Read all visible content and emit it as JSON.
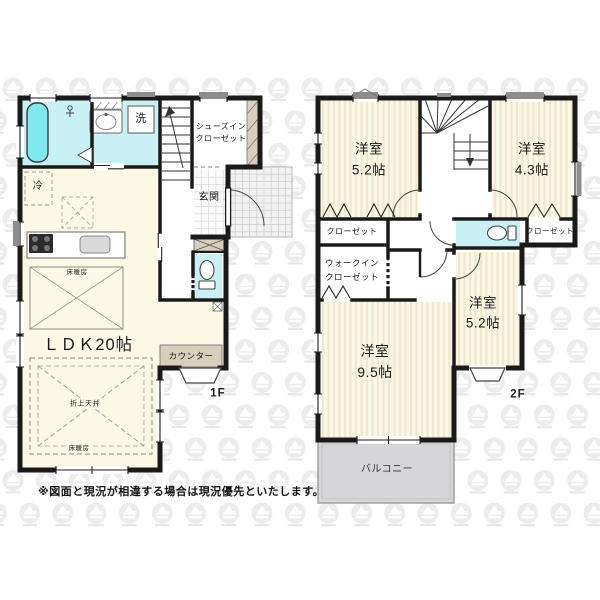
{
  "footnote": "※図面と現況が相違する場合は現況優先といたします。",
  "floor1": {
    "label": "1F",
    "ldk_label": "ＬＤＫ20帖",
    "entrance": "玄関",
    "shoes_closet_line1": "シューズイン",
    "shoes_closet_line2": "クローゼット",
    "laundry": "洗",
    "fridge": "冷",
    "counter": "カウンター",
    "floor_heating_top": "床暖房",
    "raised_ceiling": "折上天井",
    "floor_heating_bottom": "床暖房"
  },
  "floor2": {
    "label": "2F",
    "room_top_left": {
      "name": "洋室",
      "size": "5.2帖"
    },
    "room_top_right": {
      "name": "洋室",
      "size": "4.3帖"
    },
    "room_mid_right": {
      "name": "洋室",
      "size": "5.2帖"
    },
    "room_bottom_left": {
      "name": "洋室",
      "size": "9.5帖"
    },
    "closet_left": "クローゼット",
    "closet_right": "クローゼット",
    "wic_line1": "ウォークイン",
    "wic_line2": "クローゼット",
    "balcony": "バルコニー"
  },
  "colors": {
    "wall": "#1a1a1a",
    "room_cream": "#fcf8e6",
    "stripe": "#f0e7cf",
    "wet_cyan": "#c9f1f5",
    "tub_cyan": "#7fe9ed",
    "closet_beige": "#d8cebc",
    "balcony_gray": "#d6d6d8",
    "porch_gray": "#f2f2f2",
    "watermark": "#ececec"
  }
}
